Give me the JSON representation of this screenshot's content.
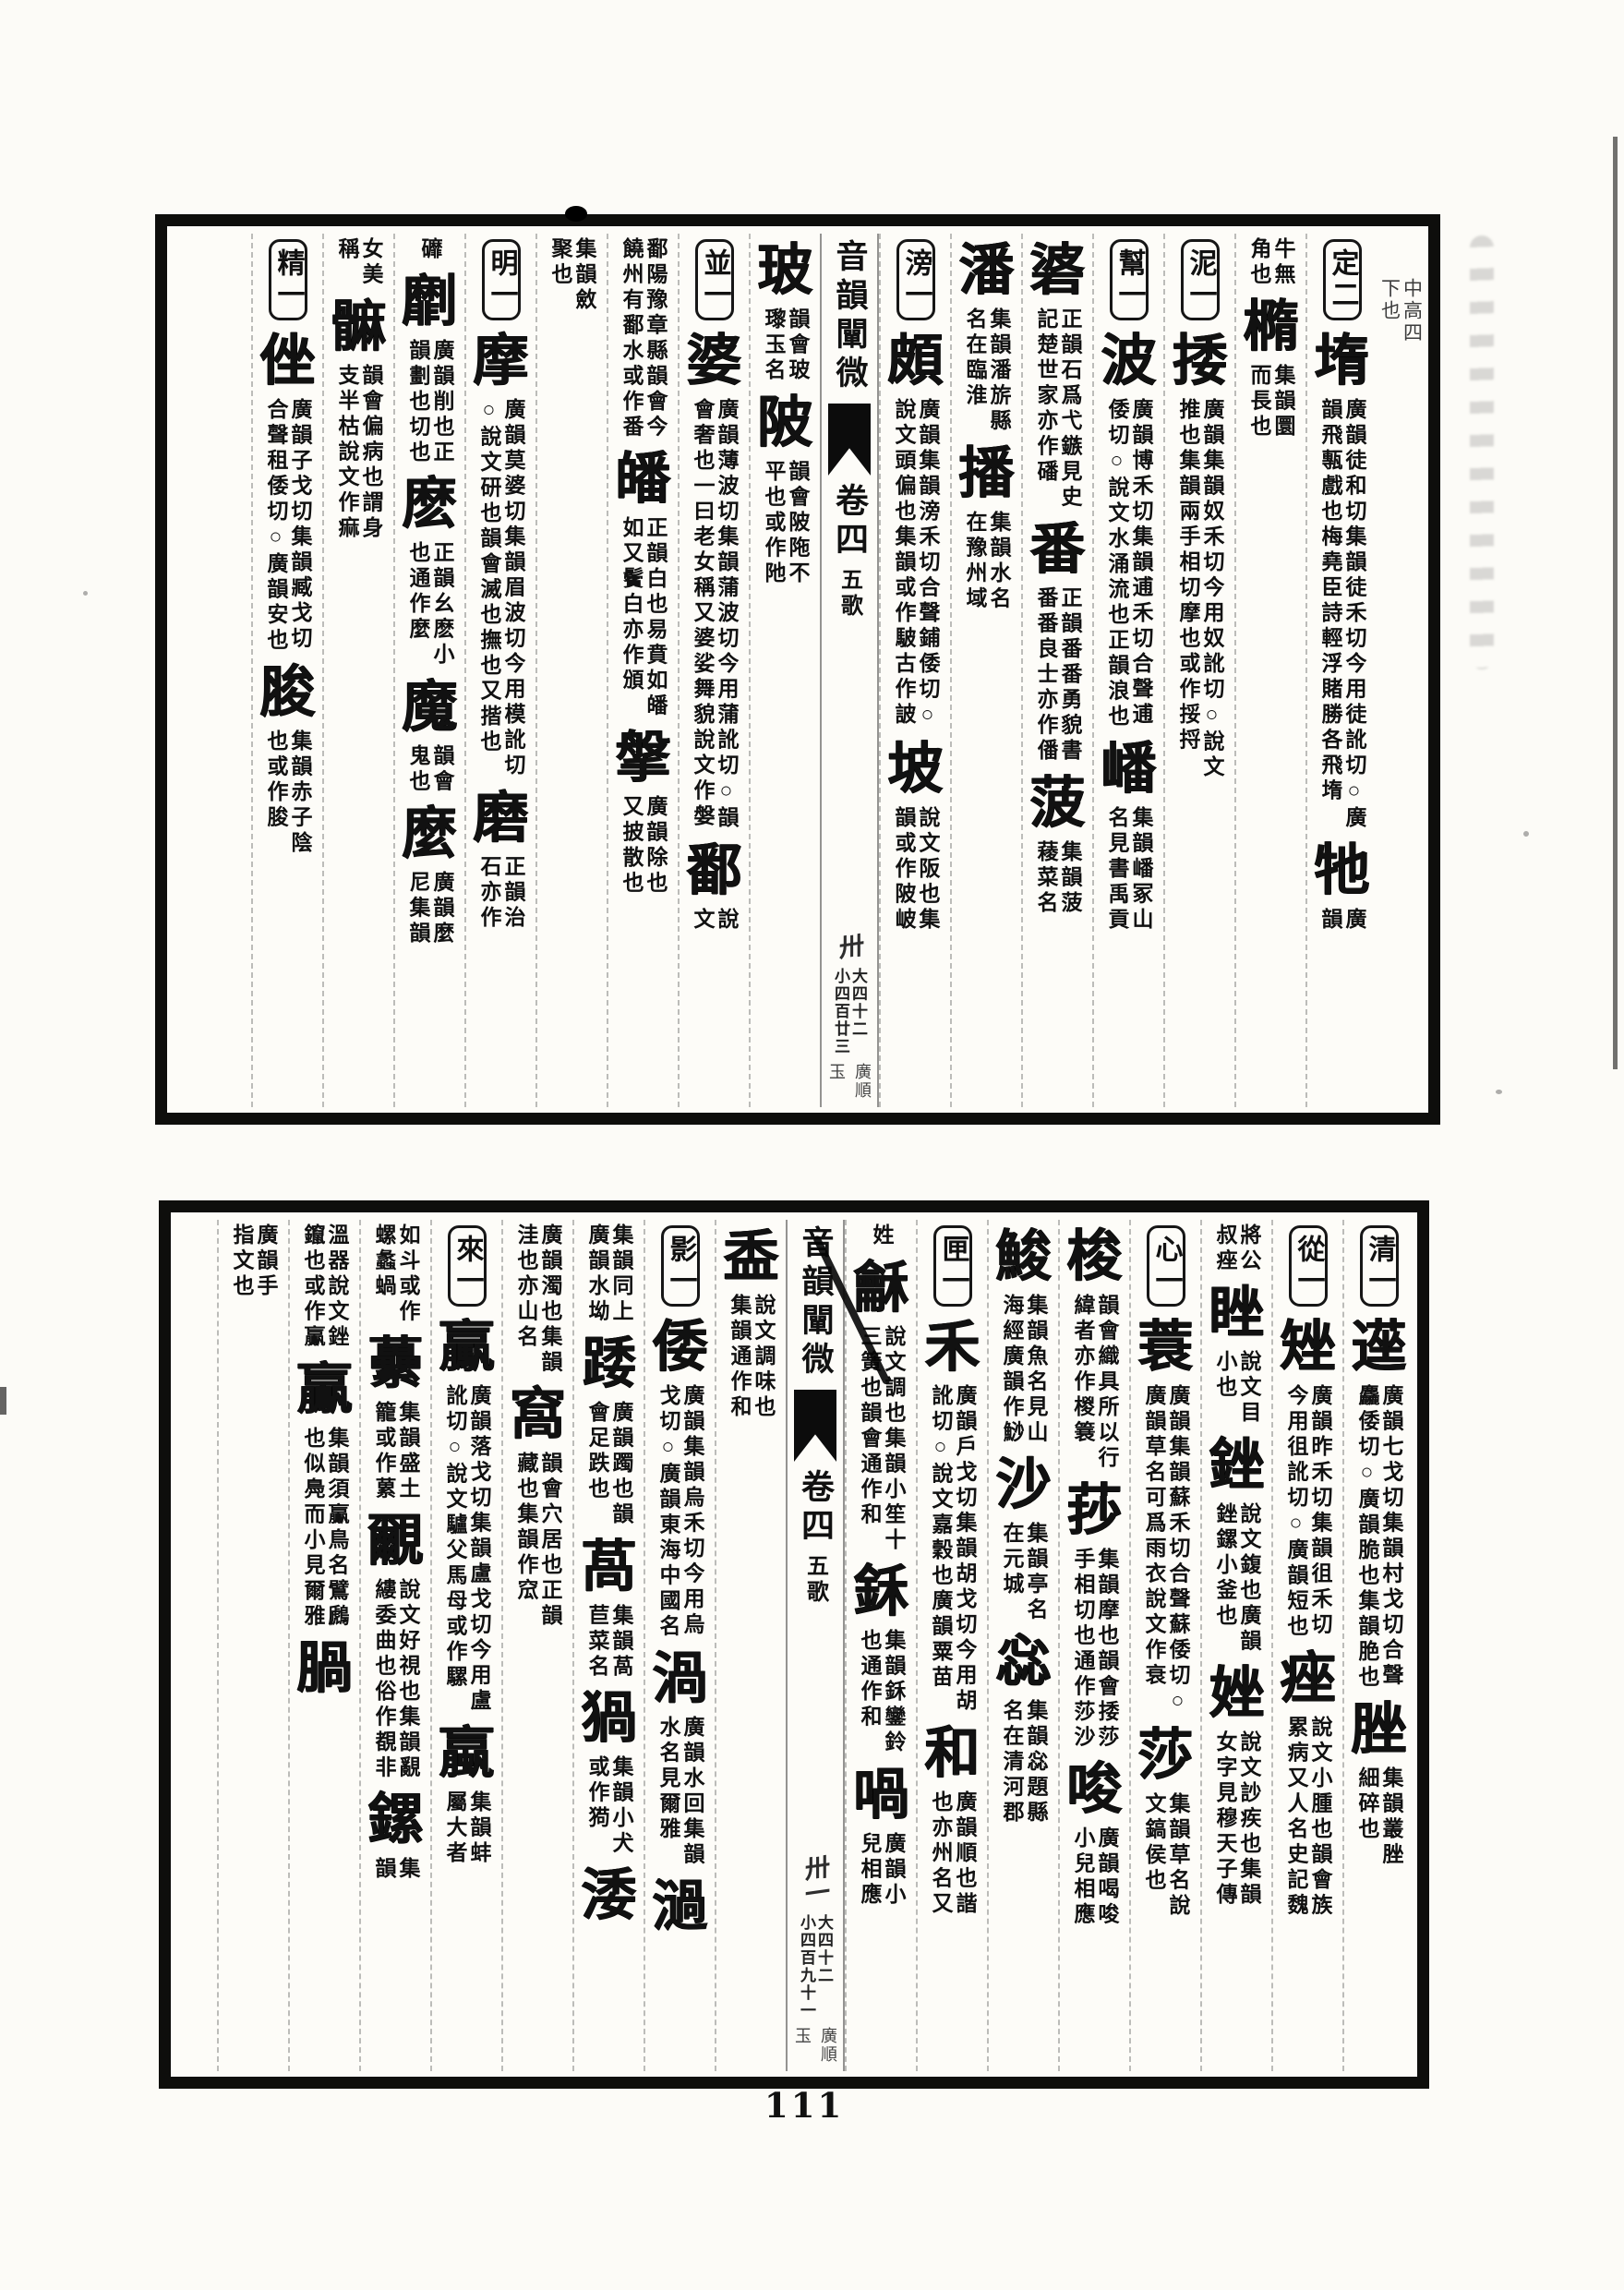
{
  "page_number": "111",
  "leaves": [
    {
      "id": "top",
      "margin_notes": [
        "中高四",
        "下也"
      ],
      "banxin": {
        "title": "音韻闡微",
        "juan": "卷四",
        "rhyme": "五歌",
        "folio": "卅",
        "large_count": "大四十二",
        "small_count": "小四百廿三",
        "marks": [
          "廣順",
          "玉"
        ]
      },
      "right_columns": [
        {
          "label": "定二",
          "segments": [
            {
              "k": "head",
              "t": "堶"
            },
            {
              "k": "note",
              "t": "廣韻徒和切集韻徒禾切今用徒訛切○廣韻飛甎戲也梅堯臣詩輕浮賭勝各飛堶"
            },
            {
              "k": "head",
              "t": "牠"
            },
            {
              "k": "note",
              "t": "廣韻"
            }
          ]
        },
        {
          "label": null,
          "segments": [
            {
              "k": "cont",
              "t": "牛無角也"
            },
            {
              "k": "head",
              "t": "橢"
            },
            {
              "k": "note",
              "t": "集韻圜而長也"
            }
          ]
        },
        {
          "label": "泥一",
          "segments": [
            {
              "k": "head",
              "t": "捼"
            },
            {
              "k": "note",
              "t": "廣韻集韻奴禾切今用奴訛切○說文推也集韻兩手相切摩也或作挼捋"
            }
          ]
        },
        {
          "label": "幫一",
          "segments": [
            {
              "k": "head",
              "t": "波"
            },
            {
              "k": "note",
              "t": "廣韻博禾切集韻逋禾切合聲逋倭切○說文水涌流也正韻浪也"
            },
            {
              "k": "head",
              "t": "嶓"
            },
            {
              "k": "note",
              "t": "集韻嶓冢山名見書禹貢"
            }
          ]
        },
        {
          "label": null,
          "segments": [
            {
              "k": "head",
              "t": "碆"
            },
            {
              "k": "note",
              "t": "正韻石爲弋鏃見史記楚世家亦作磻"
            },
            {
              "k": "head",
              "t": "番"
            },
            {
              "k": "note",
              "t": "正韻番番勇貌書番番良士亦作僠"
            },
            {
              "k": "head",
              "t": "菠"
            },
            {
              "k": "note",
              "t": "集韻菠薐菜名"
            }
          ]
        },
        {
          "label": null,
          "segments": [
            {
              "k": "head",
              "t": "潘"
            },
            {
              "k": "note",
              "t": "集韻潘旂縣名在臨淮"
            },
            {
              "k": "head",
              "t": "播"
            },
            {
              "k": "note",
              "t": "集韻水名在豫州域"
            }
          ]
        },
        {
          "label": "滂一",
          "segments": [
            {
              "k": "head",
              "t": "頗"
            },
            {
              "k": "note",
              "t": "廣韻集韻滂禾切合聲鋪倭切○說文頭偏也集韻或作駊古作詖"
            },
            {
              "k": "head",
              "t": "坡"
            },
            {
              "k": "note",
              "t": "說文阪也集韻或作陂岥"
            }
          ]
        }
      ],
      "left_columns": [
        {
          "label": null,
          "segments": [
            {
              "k": "head",
              "t": "玻"
            },
            {
              "k": "note",
              "t": "韻會玻瓈玉名"
            },
            {
              "k": "head",
              "t": "陂"
            },
            {
              "k": "note",
              "t": "韻會陂陁不平也或作阤"
            }
          ]
        },
        {
          "label": "並一",
          "segments": [
            {
              "k": "head",
              "t": "婆"
            },
            {
              "k": "note",
              "t": "廣韻薄波切集韻蒲波切今用蒲訛切○韻會奢也一曰老女稱又婆娑舞貌說文作媻"
            },
            {
              "k": "head",
              "t": "鄱"
            },
            {
              "k": "note",
              "t": "說文"
            }
          ]
        },
        {
          "label": null,
          "segments": [
            {
              "k": "cont",
              "t": "鄱陽豫章縣韻會今饒州有鄱水或作番"
            },
            {
              "k": "head",
              "t": "皤"
            },
            {
              "k": "note",
              "t": "正韻白也易賁如皤如又鬢白亦作頒"
            },
            {
              "k": "head",
              "t": "搫"
            },
            {
              "k": "note",
              "t": "廣韻除也又披散也"
            }
          ]
        },
        {
          "label": null,
          "segments": [
            {
              "k": "cont",
              "t": "集韻斂聚也"
            }
          ]
        },
        {
          "label": "明一",
          "segments": [
            {
              "k": "head",
              "t": "摩"
            },
            {
              "k": "note",
              "t": "廣韻莫婆切集韻眉波切今用模訛切○說文研也韻會滅也撫也又揩也"
            },
            {
              "k": "head",
              "t": "磨"
            },
            {
              "k": "note",
              "t": "正韻治石亦作"
            }
          ]
        },
        {
          "label": null,
          "segments": [
            {
              "k": "cont",
              "t": "䃺"
            },
            {
              "k": "head",
              "t": "劘"
            },
            {
              "k": "note",
              "t": "廣韻削也正韻劃也切也"
            },
            {
              "k": "head",
              "t": "麽"
            },
            {
              "k": "note",
              "t": "正韻幺麽小也通作麼"
            },
            {
              "k": "head",
              "t": "魔"
            },
            {
              "k": "note",
              "t": "韻會鬼也"
            },
            {
              "k": "head",
              "t": "麼"
            },
            {
              "k": "note",
              "t": "廣韻麼尼集韻"
            }
          ]
        },
        {
          "label": null,
          "segments": [
            {
              "k": "cont",
              "t": "女美稱"
            },
            {
              "k": "head",
              "t": "髍"
            },
            {
              "k": "note",
              "t": "韻會偏病也謂身支半枯說文作痲"
            }
          ]
        },
        {
          "label": "精一",
          "segments": [
            {
              "k": "head",
              "t": "侳"
            },
            {
              "k": "note",
              "t": "廣韻子戈切集韻臧戈切合聲租倭切○廣韻安也"
            },
            {
              "k": "head",
              "t": "脧"
            },
            {
              "k": "note",
              "t": "集韻赤子陰也或作朘"
            }
          ]
        }
      ]
    },
    {
      "id": "bottom",
      "margin_notes": [],
      "banxin": {
        "title": "音韻闡微",
        "juan": "卷四",
        "rhyme": "五歌",
        "folio": "卅一",
        "large_count": "大四十二",
        "small_count": "小四百九十一",
        "marks": [
          "廣順",
          "玉"
        ]
      },
      "right_columns": [
        {
          "label": "清一",
          "segments": [
            {
              "k": "head",
              "t": "遳"
            },
            {
              "k": "note",
              "t": "廣韻七戈切集韻村戈切合聲麤倭切○廣韻脆也集韻脃也"
            },
            {
              "k": "head",
              "t": "脞"
            },
            {
              "k": "note",
              "t": "集韻叢脞細碎也"
            }
          ]
        },
        {
          "label": "從一",
          "segments": [
            {
              "k": "head",
              "t": "矬"
            },
            {
              "k": "note",
              "t": "廣韻昨禾切集韻徂禾切今用徂訛切○廣韻短也"
            },
            {
              "k": "head",
              "t": "痤"
            },
            {
              "k": "note",
              "t": "說文小腫也韻會族累病又人名史記魏"
            }
          ]
        },
        {
          "label": null,
          "segments": [
            {
              "k": "cont",
              "t": "將公叔痤"
            },
            {
              "k": "head",
              "t": "睉"
            },
            {
              "k": "note",
              "t": "說文目小也"
            },
            {
              "k": "head",
              "t": "銼"
            },
            {
              "k": "note",
              "t": "說文鍑也廣韻銼鏍小釜也"
            },
            {
              "k": "head",
              "t": "㛗"
            },
            {
              "k": "note",
              "t": "說文訬疾也集韻女字見穆天子傳"
            }
          ]
        },
        {
          "label": "心一",
          "segments": [
            {
              "k": "head",
              "t": "蓑"
            },
            {
              "k": "note",
              "t": "廣韻集韻蘇禾切合聲蘇倭切○廣韻草名可爲雨衣說文作衰"
            },
            {
              "k": "head",
              "t": "莎"
            },
            {
              "k": "note",
              "t": "集韻草名說文鎬侯也"
            }
          ]
        },
        {
          "label": null,
          "segments": [
            {
              "k": "head",
              "t": "梭"
            },
            {
              "k": "note",
              "t": "韻會織具所以行緯者亦作椶簔"
            },
            {
              "k": "head",
              "t": "莏"
            },
            {
              "k": "note",
              "t": "集韻摩也韻會捼莎手相切也通作莎沙"
            },
            {
              "k": "head",
              "t": "唆"
            },
            {
              "k": "note",
              "t": "廣韻喝唆小兒相應"
            }
          ]
        },
        {
          "label": null,
          "segments": [
            {
              "k": "head",
              "t": "鮻"
            },
            {
              "k": "note",
              "t": "集韻魚名見山海經廣韻作鯋"
            },
            {
              "k": "head",
              "t": "沙"
            },
            {
              "k": "note",
              "t": "集韻亭名在元城"
            },
            {
              "k": "head",
              "t": "惢"
            },
            {
              "k": "note",
              "t": "集韻惢題縣名在清河郡"
            }
          ]
        },
        {
          "label": "匣一",
          "segments": [
            {
              "k": "head",
              "t": "禾"
            },
            {
              "k": "note",
              "t": "廣韻戶戈切集韻胡戈切今用胡訛切○說文嘉穀也廣韻粟苗"
            },
            {
              "k": "head",
              "t": "和"
            },
            {
              "k": "note",
              "t": "廣韻順也諧也亦州名又"
            }
          ]
        },
        {
          "label": null,
          "segments": [
            {
              "k": "cont",
              "t": "姓"
            },
            {
              "k": "head",
              "t": "龢"
            },
            {
              "k": "note",
              "t": "說文調也集韻小笙十三簧也韻會通作和"
            },
            {
              "k": "head",
              "t": "鉌"
            },
            {
              "k": "note",
              "t": "集韻鉌鑾鈴也通作和"
            },
            {
              "k": "head",
              "t": "喎"
            },
            {
              "k": "note",
              "t": "廣韻小兒相應"
            }
          ]
        }
      ],
      "left_columns": [
        {
          "label": null,
          "segments": [
            {
              "k": "head",
              "t": "盉"
            },
            {
              "k": "note",
              "t": "說文調味也集韻通作和"
            }
          ]
        },
        {
          "label": "影一",
          "segments": [
            {
              "k": "head",
              "t": "倭"
            },
            {
              "k": "note",
              "t": "廣韻集韻烏禾切今用烏戈切○廣韻東海中國名"
            },
            {
              "k": "head",
              "t": "渦"
            },
            {
              "k": "note",
              "t": "廣韻水回集韻水名見爾雅"
            },
            {
              "k": "head",
              "t": "濄"
            }
          ]
        },
        {
          "label": null,
          "segments": [
            {
              "k": "cont",
              "t": "集韻同上廣韻水坳"
            },
            {
              "k": "head",
              "t": "踒"
            },
            {
              "k": "note",
              "t": "廣韻躅也韻會足跌也"
            },
            {
              "k": "head",
              "t": "萵"
            },
            {
              "k": "note",
              "t": "集韻萵苣菜名"
            },
            {
              "k": "head",
              "t": "猧"
            },
            {
              "k": "note",
              "t": "集韻小犬或作㺃"
            },
            {
              "k": "head",
              "t": "涹"
            }
          ]
        },
        {
          "label": null,
          "segments": [
            {
              "k": "cont",
              "t": "廣韻濁也集韻洼也亦山名"
            },
            {
              "k": "head",
              "t": "窩"
            },
            {
              "k": "note",
              "t": "韻會穴居也正韻藏也集韻作窊"
            }
          ]
        },
        {
          "label": "來一",
          "segments": [
            {
              "k": "head",
              "t": "驘"
            },
            {
              "k": "note",
              "t": "廣韻落戈切集韻盧戈切今用盧訛切○說文驢父馬母或作騾"
            },
            {
              "k": "head",
              "t": "蠃"
            },
            {
              "k": "note",
              "t": "集韻蚌屬大者"
            }
          ]
        },
        {
          "label": null,
          "segments": [
            {
              "k": "cont",
              "t": "如斗或作螺蠡蝸"
            },
            {
              "k": "head",
              "t": "虆"
            },
            {
              "k": "note",
              "t": "集韻盛土籠或作蔂"
            },
            {
              "k": "head",
              "t": "覼"
            },
            {
              "k": "note",
              "t": "說文好視也集韻覶縷委曲也俗作覩非"
            },
            {
              "k": "head",
              "t": "鏍"
            },
            {
              "k": "note",
              "t": "集韻"
            }
          ]
        },
        {
          "label": null,
          "segments": [
            {
              "k": "cont",
              "t": "溫器說文銼鑹也或作鸁"
            },
            {
              "k": "head",
              "t": "鸁"
            },
            {
              "k": "note",
              "t": "集韻須鸁鳥名鷿鷉也似鳧而小見爾雅"
            },
            {
              "k": "head",
              "t": "腡"
            }
          ]
        },
        {
          "label": null,
          "segments": [
            {
              "k": "cont",
              "t": "廣韻手指文也"
            }
          ]
        }
      ]
    }
  ]
}
